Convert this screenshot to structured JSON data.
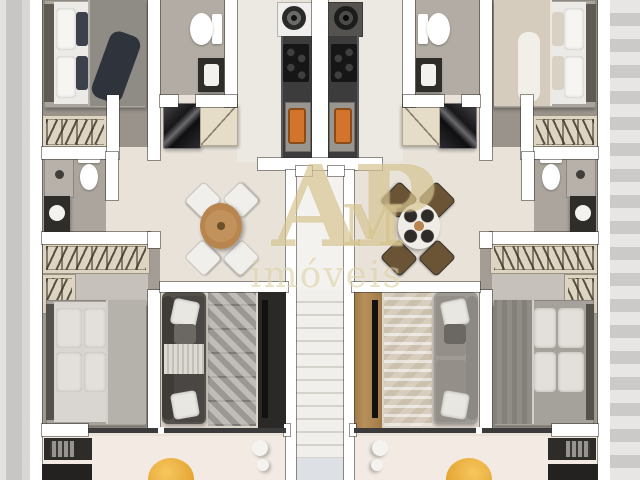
{
  "watermark": {
    "line1": "AP",
    "line2": "M",
    "line3": "imóveis"
  },
  "scene": {
    "kind": "floor-plan-render",
    "units": [
      "apartment-unit-left",
      "apartment-unit-right"
    ],
    "rooms": [
      "bedroom-top",
      "bathroom-top",
      "kitchen",
      "hall-dining",
      "bathroom-middle",
      "closet",
      "bedroom-bottom",
      "living-room",
      "balcony",
      "staircase"
    ],
    "furniture": [
      "double-bed",
      "wardrobe-rack",
      "toilet",
      "shower",
      "washbasin",
      "washing-machine",
      "cooktop",
      "kitchen-sink",
      "refrigerator",
      "shoe-cabinet",
      "dining-table",
      "dining-chair",
      "sofa",
      "rug",
      "tv-panel",
      "barbecue-counter",
      "pouf",
      "vases",
      "stairs"
    ]
  },
  "palette": {
    "wall": "#ffffff",
    "floor_light": "#e8e2d9",
    "floor_gray": "#99938b",
    "counter_dark": "#3c3c3c",
    "sink_orange": "#d2742b",
    "pouf_yellow": "#edb249",
    "wood": "#b8854e",
    "watermark_gold": "#c9b272",
    "exterior_gray": "#cfcecc"
  }
}
